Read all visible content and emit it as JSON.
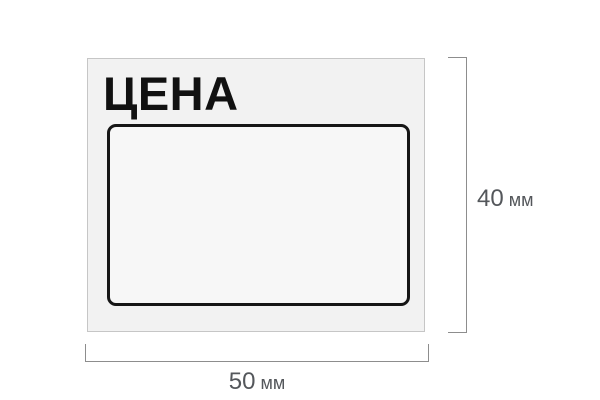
{
  "price_tag": {
    "title": "ЦЕНА"
  },
  "dimensions": {
    "height": {
      "value": "40",
      "unit": "мм"
    },
    "width": {
      "value": "50",
      "unit": "мм"
    }
  },
  "colors": {
    "background": "#ffffff",
    "tag_fill": "#f2f2f2",
    "tag_border": "#c6c6c6",
    "frame_stroke": "#161616",
    "frame_fill": "#f7f7f7",
    "dim_line": "#8d8d8d",
    "dim_text": "#54575b",
    "title_text": "#111111"
  }
}
